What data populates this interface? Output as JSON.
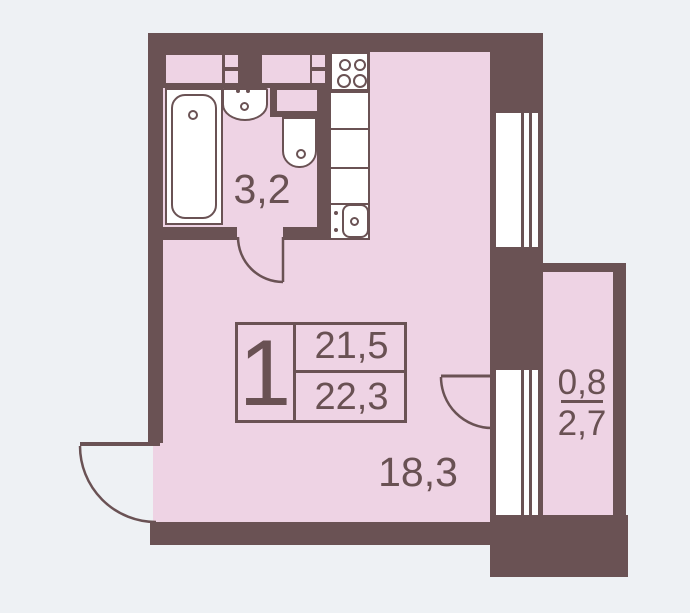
{
  "plan_title": "studio-apartment-floor-plan",
  "rooms": {
    "bathroom_area": "3,2",
    "living_area_label": "18,3",
    "balcony_area_reduced": "0,8",
    "balcony_area_full": "2,7"
  },
  "stamp": {
    "apartment_number": "1",
    "living_area": "21,5",
    "total_area": "22,3"
  },
  "colors": {
    "wall": "#6a5254",
    "room_fill": "#eed3e4",
    "background": "#eef1f4",
    "fixture_fill": "#ffffff",
    "text": "#695153"
  }
}
